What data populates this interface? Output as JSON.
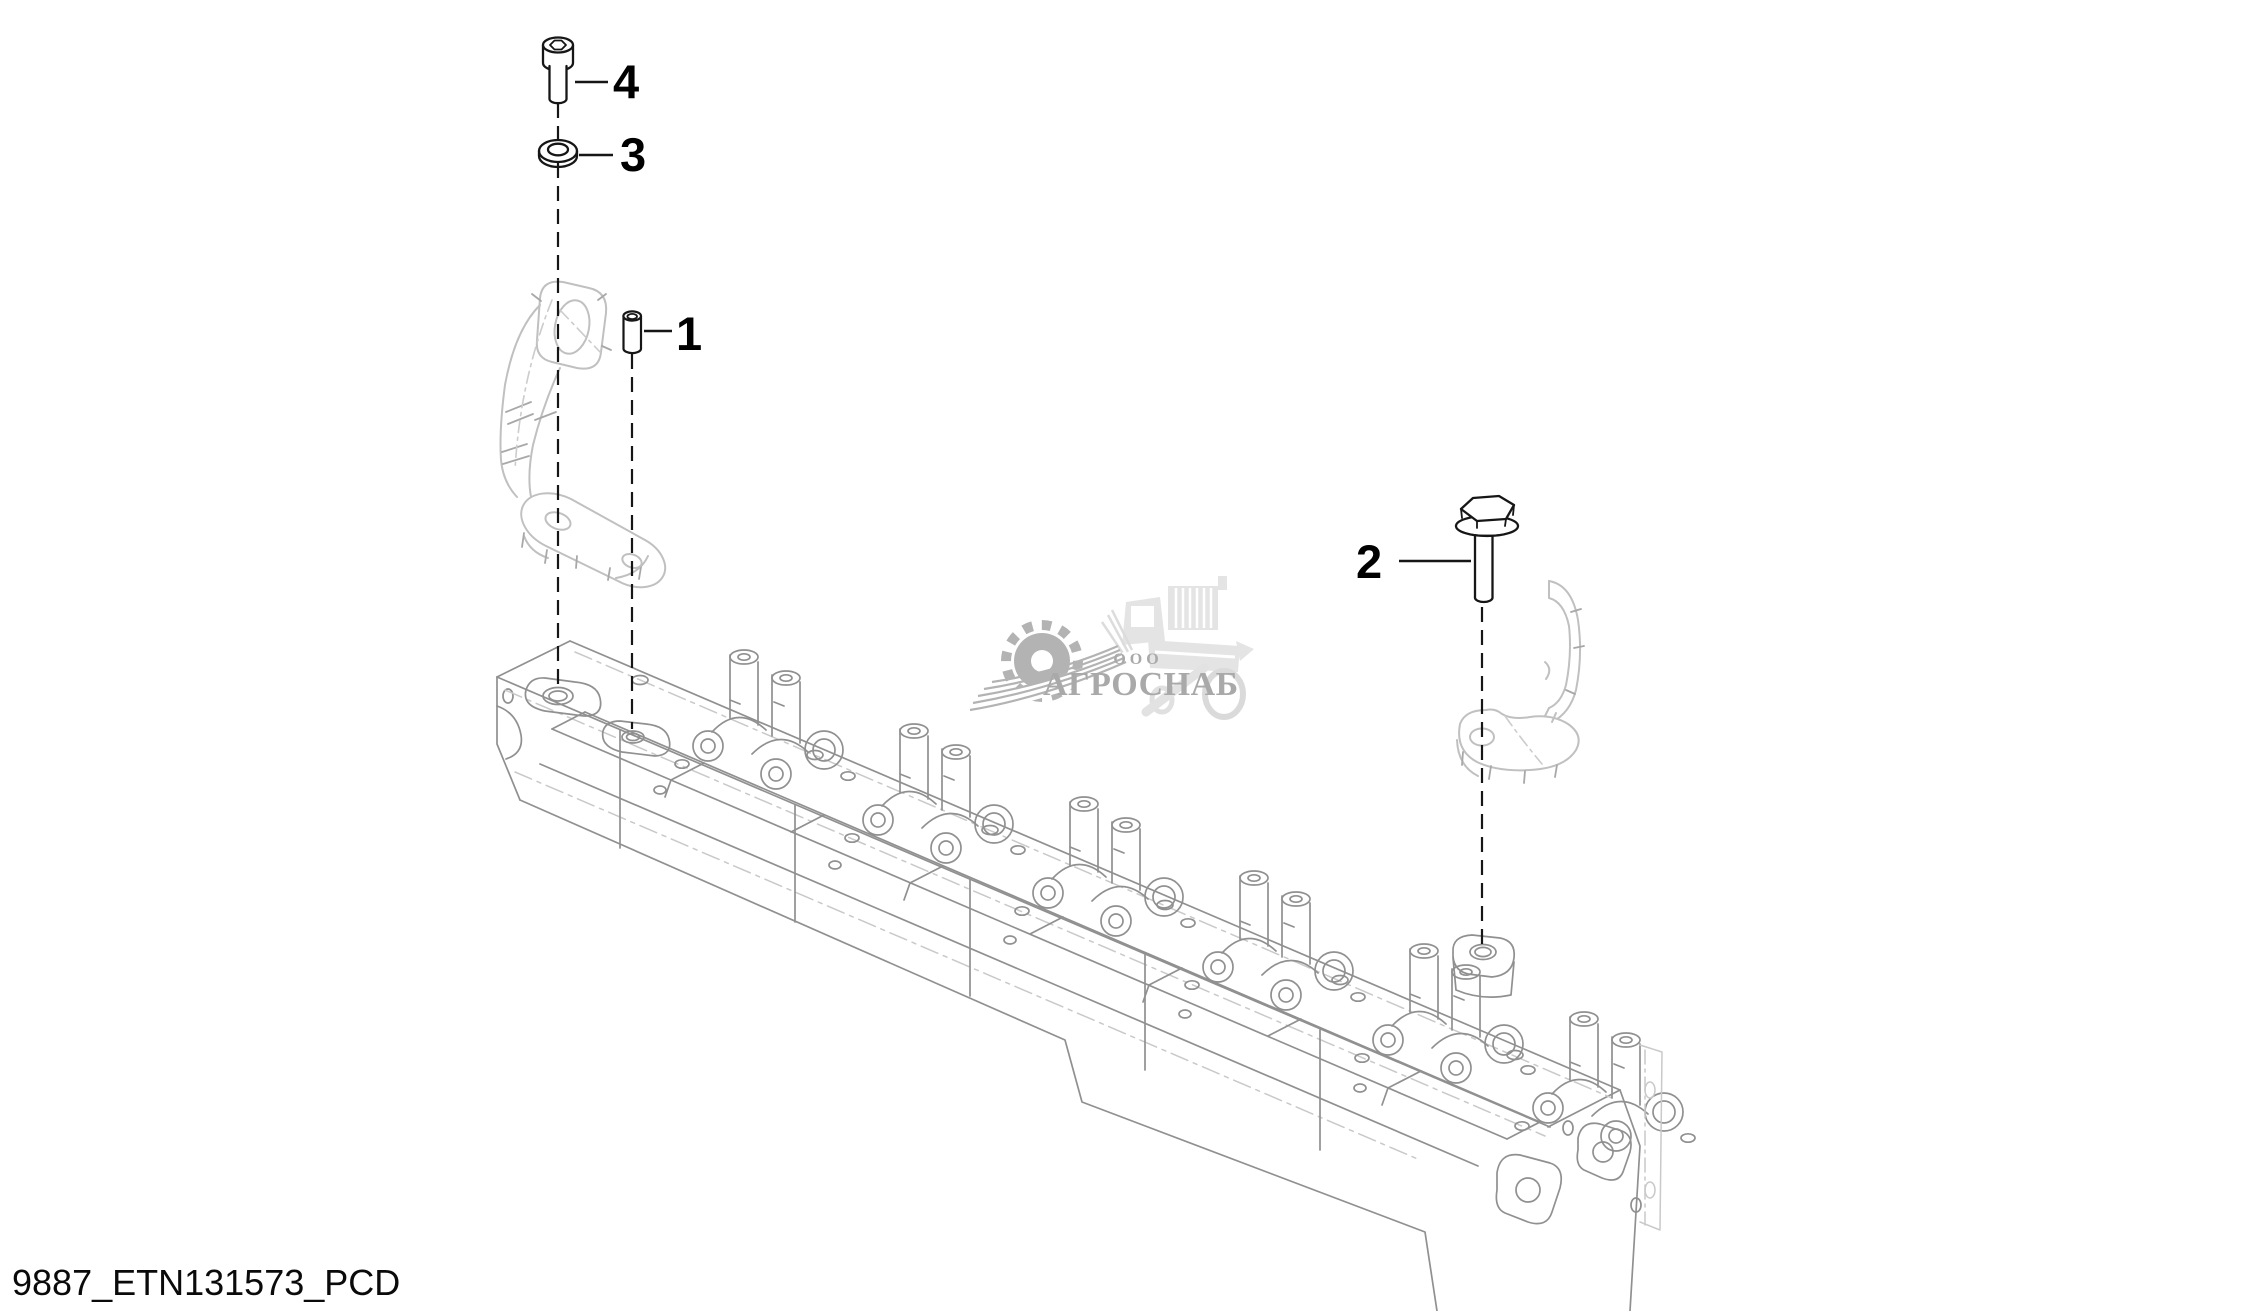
{
  "canvas": {
    "width": 2245,
    "height": 1311,
    "background": "#ffffff"
  },
  "colors": {
    "part_line": "#161616",
    "head_line": "#909090",
    "head_line_faint": "#c9c9c9",
    "bracket_line": "#c0c0c0",
    "label_color": "#000000",
    "watermark_graphic": "#b3b3b3",
    "watermark_text": "#a9a9a9",
    "watermark_silhouette": "#e4e4e4"
  },
  "callouts": [
    {
      "label": "1"
    },
    {
      "label": "2"
    },
    {
      "label": "3"
    },
    {
      "label": "4"
    }
  ],
  "watermark": {
    "prefix": "ООО",
    "name": "АГРОСНАБ"
  },
  "caption": {
    "text": "9887_ETN131573_PCD"
  }
}
